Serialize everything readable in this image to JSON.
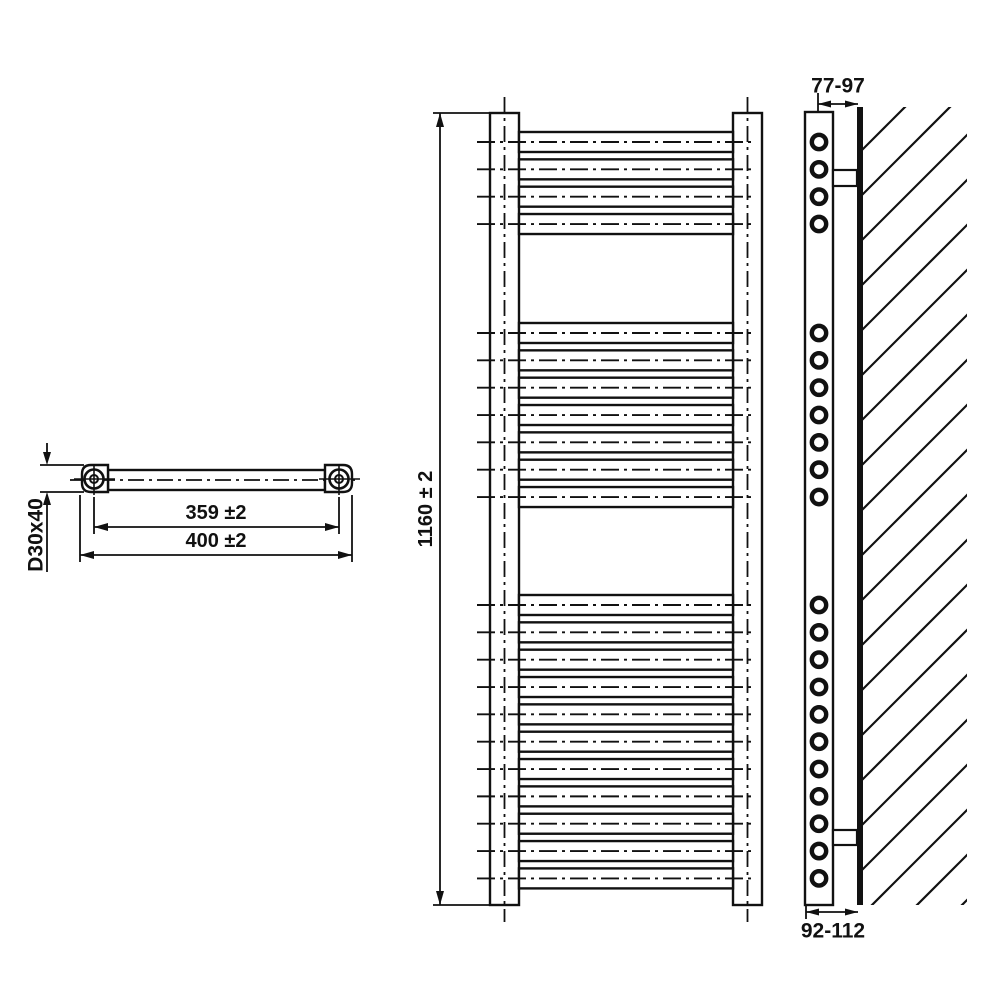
{
  "page": {
    "background": "#ffffff",
    "ink": "#111111"
  },
  "views": {
    "top_view": {
      "title": "bracket-top-view",
      "dim_hole_spacing": "359 ±2",
      "dim_overall_width": "400 ±2",
      "dim_tube": "D30x40"
    },
    "front_view": {
      "title": "radiator-front-view",
      "dim_height": "1160 ± 2",
      "rung_groups": [
        4,
        7,
        11
      ],
      "rung_total": 22
    },
    "side_view": {
      "title": "radiator-side-view-on-wall",
      "dim_wall_to_center": "77-97",
      "dim_wall_to_front": "92-112"
    }
  }
}
